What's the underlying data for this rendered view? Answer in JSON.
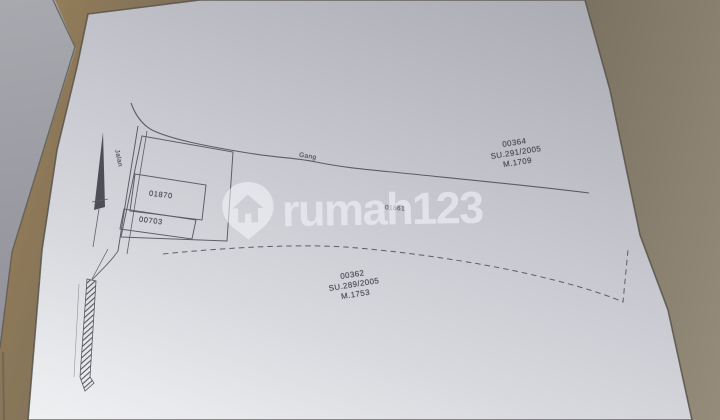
{
  "watermark": {
    "brand": "rumah123",
    "icon": "home-pin-icon"
  },
  "map": {
    "alley_label": "Gang",
    "street_label": "Jalan",
    "parcel_left_top": "01870",
    "parcel_left_bottom": "00703",
    "parcel_center": "01861",
    "parcel_block_top_right": {
      "lines": [
        "00364",
        "SU.291/2005",
        "M.1709"
      ]
    },
    "parcel_block_bottom": {
      "lines": [
        "00362",
        "SU.289/2005",
        "M.1753"
      ]
    }
  },
  "colors": {
    "paper": "#cdced4",
    "table": "#6e6457",
    "ink": "#4b4c56",
    "watermark": "rgba(246,247,251,0.55)"
  }
}
